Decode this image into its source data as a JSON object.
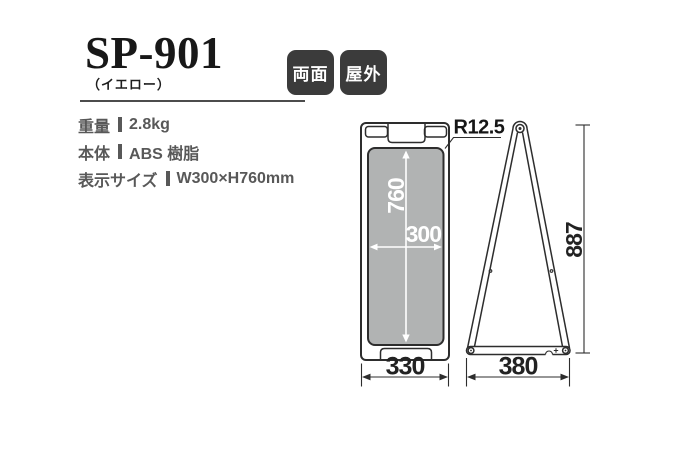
{
  "product": {
    "model": "SP-901",
    "variant": "（イエロー）",
    "badges": [
      {
        "label": "両面"
      },
      {
        "label": "屋外"
      }
    ]
  },
  "specs": {
    "rows": [
      {
        "label": "重量",
        "value": "2.8kg"
      },
      {
        "label": "本体",
        "value": "ABS 樹脂"
      },
      {
        "label": "表示サイズ",
        "value": "W300×H760mm"
      }
    ]
  },
  "diagram": {
    "front_view": {
      "display_height": "760",
      "display_width": "300",
      "base_width": "330",
      "corner_radius": "R12.5"
    },
    "side_view": {
      "overall_height": "887",
      "stance_depth": "380"
    }
  },
  "colors": {
    "panel_gray": "#b1b3b3",
    "badge_bg": "#3b3b3b",
    "line": "#2d2d2d",
    "spec_text": "#585858"
  }
}
